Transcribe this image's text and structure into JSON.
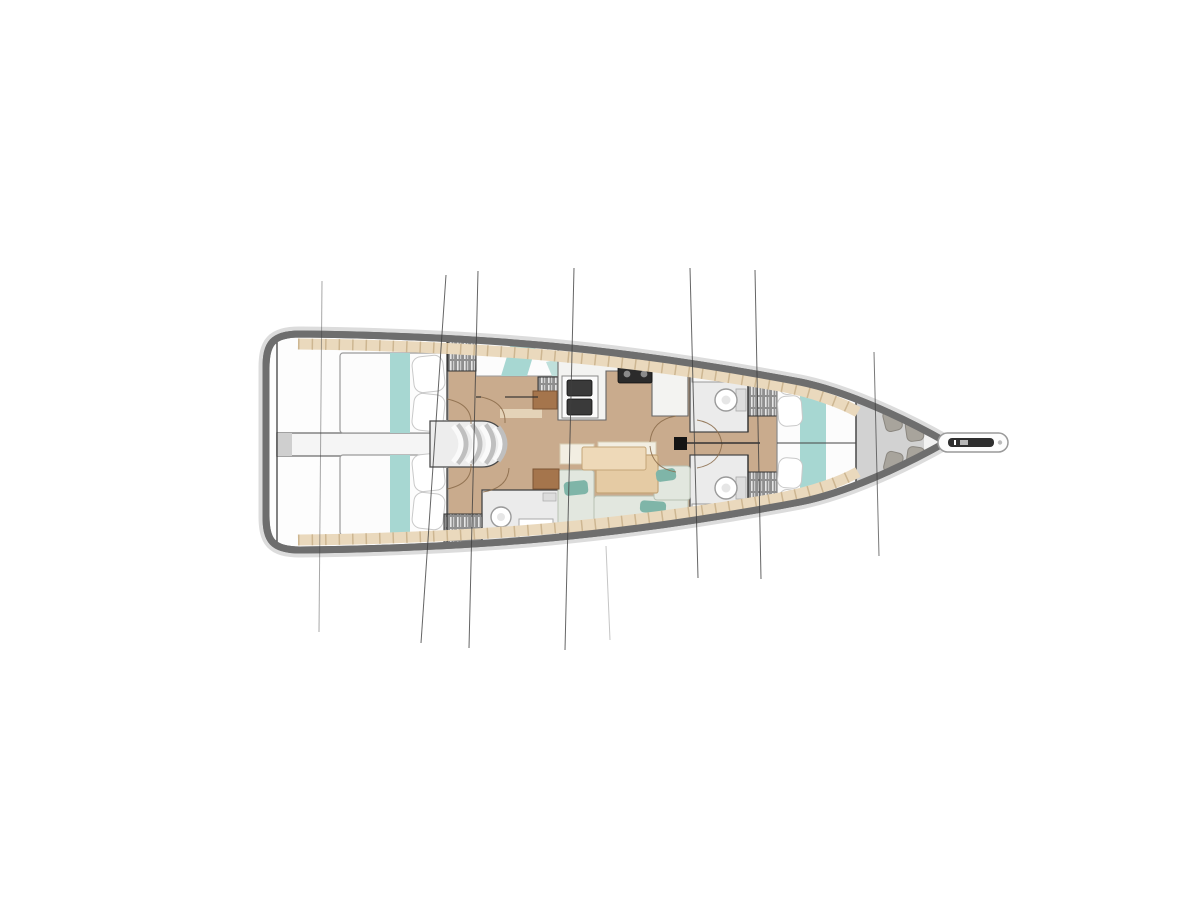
{
  "page": {
    "background": "#ffffff"
  },
  "colors": {
    "hull_halo": "#dcdcdc",
    "hull_border": "#6e6e6e",
    "hull_fill": "#fdfdfd",
    "deck": "#ead9bd",
    "deck_tick": "#cdb691",
    "floor": "#c9ab8d",
    "floor_step": "#e4d3b8",
    "teal": "#a7d7d2",
    "teal_soft": "#bfe0db",
    "bed_white": "#fcfcfc",
    "bed_stroke": "#9a9a9a",
    "pillow_stroke": "#c9c9c9",
    "corridor": "#f5f5f5",
    "corridor_cap": "#cfcfcf",
    "wall": "#2e2e2e",
    "locker_gray": "#8f8f8f",
    "locker_hatch": "#e6e6e6",
    "head_floor": "#ebebeb",
    "fixture_white": "#ffffff",
    "fixture_stroke": "#9a9a9a",
    "counter": "#f3f3f1",
    "counter_stroke": "#666666",
    "sink_dark": "#3a3a3a",
    "stove_dark": "#2b2b2b",
    "burner_gray": "#8a8a8a",
    "table_wood": "#e5cba4",
    "table_wood_light": "#eed9b8",
    "table_stroke": "#c4a578",
    "settee": "#e2e7df",
    "settee_stroke": "#b8c0b3",
    "seatback": "#f2eee2",
    "seatback_stroke": "#d8cdb4",
    "cushion_teal": "#7fb5a8",
    "desk_brown": "#a5754c",
    "desk_stroke": "#7c5433",
    "bow_locker": "#d2d2d2",
    "bow_locker_stroke": "#9a9a9a",
    "fender": "#a8a49c",
    "fender_stroke": "#8b8780",
    "stairs_fill": "#ededed",
    "step_shade": "#bfbfbf",
    "step_light": "#fafafa",
    "rig_line": "#3f3f3f",
    "door_arc": "#8a6b4a",
    "mast_black": "#141414",
    "bowsprit_dark": "#2f2f2f"
  }
}
